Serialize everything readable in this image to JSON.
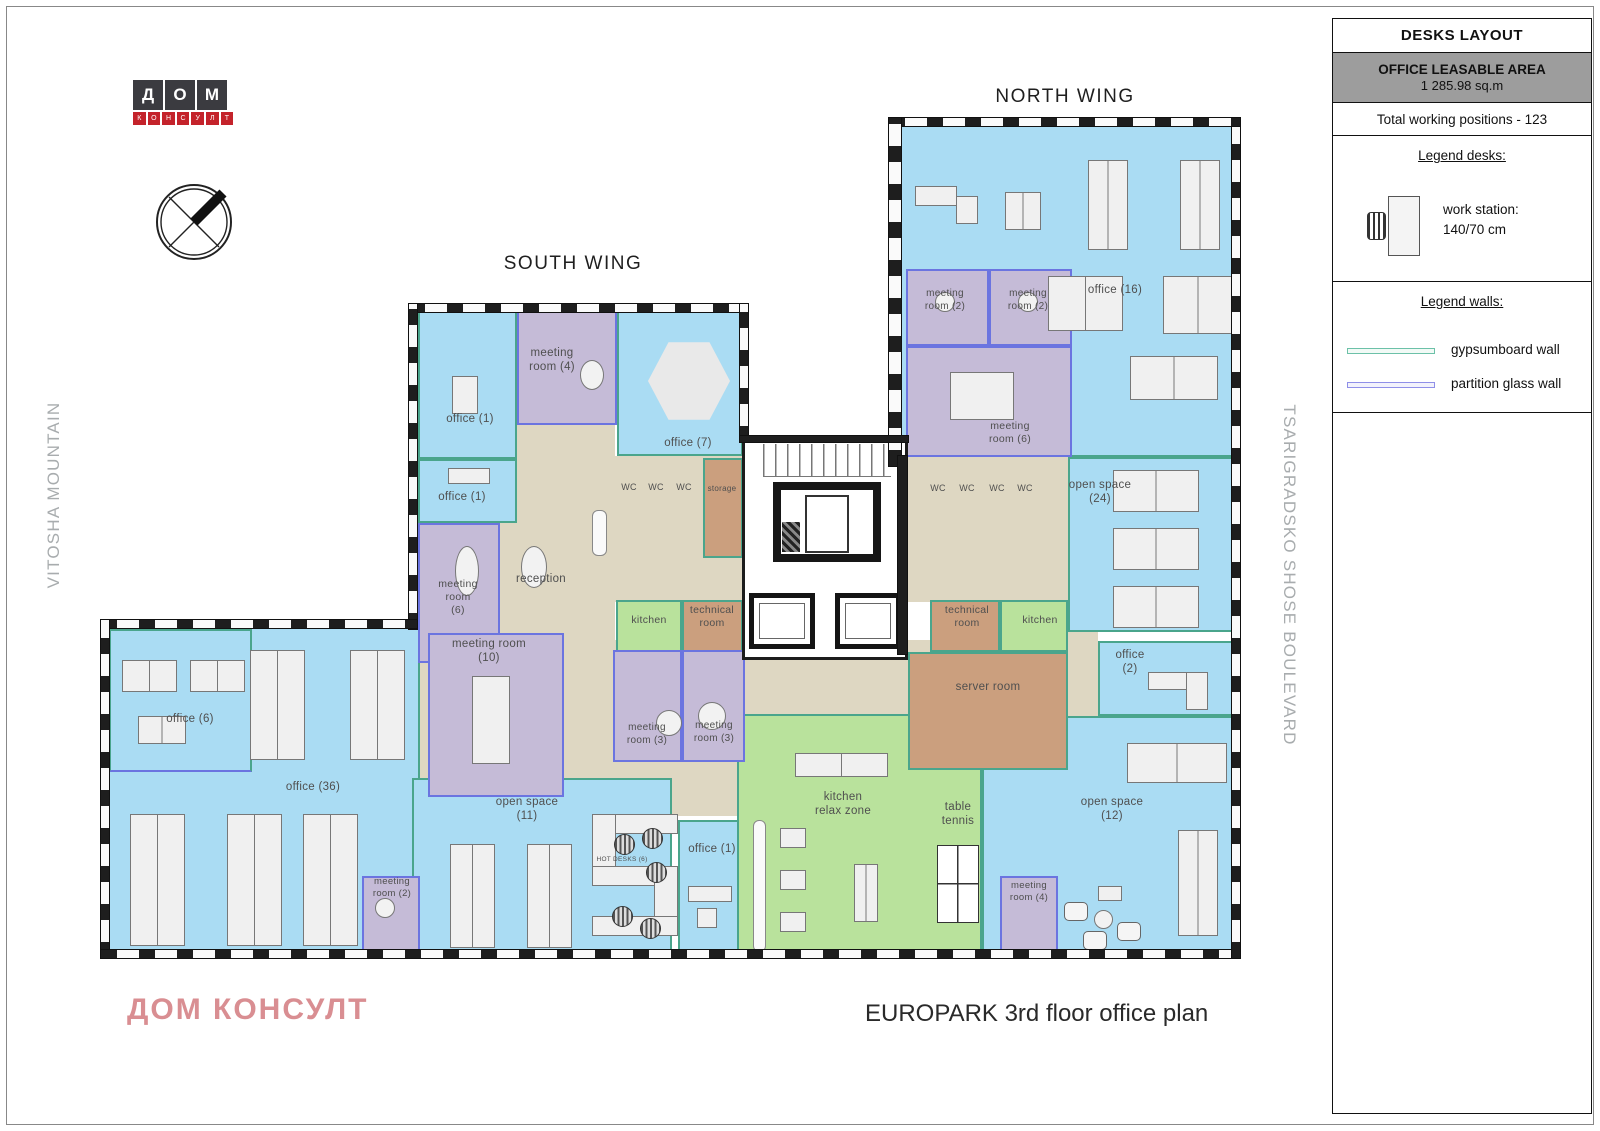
{
  "sidebar": {
    "title": "DESKS LAYOUT",
    "leasable_area_label": "OFFICE LEASABLE AREA",
    "leasable_area_value": "1 285.98 sq.m",
    "total_positions": "Total working positions - 123",
    "legend_desks": {
      "heading": "Legend desks:",
      "workstation_label": "work station:",
      "workstation_size": "140/70 cm"
    },
    "legend_walls": {
      "heading": "Legend walls:",
      "items": [
        {
          "label": "gypsumboard wall",
          "color": "#6cc1a8"
        },
        {
          "label": "partition glass wall",
          "color": "#8f8fe8"
        }
      ]
    }
  },
  "logo": {
    "row1": [
      "Д",
      "О",
      "М"
    ],
    "row2": [
      "К",
      "О",
      "Н",
      "С",
      "У",
      "Л",
      "Т"
    ]
  },
  "headings": {
    "south_wing": "SOUTH WING",
    "north_wing": "NORTH WING"
  },
  "context_labels": {
    "left": "VITOSHA MOUNTAIN",
    "right": "TSARIGRADSKO SHOSE BOULEVARD"
  },
  "footer": {
    "company": "ДОМ КОНСУЛТ",
    "plan_title": "EUROPARK 3rd floor office plan"
  },
  "palette": {
    "office_blue": "#aadcf3",
    "meeting_purple": "#c5bbd7",
    "relax_green": "#b9e29c",
    "service_tan": "#cb9f7e",
    "corridor_beige": "#ded7c2",
    "wall_dark": "#1e1e1e",
    "gypsum_wall": "#4aa58c",
    "glass_wall": "#6b74e0",
    "brand_red": "#c4232b",
    "footer_pink": "#d98e92",
    "context_gray": "#a8acae"
  },
  "plan": {
    "rooms": [
      {
        "n": "corridor-reception",
        "c": "beige",
        "x": 497,
        "y": 423,
        "w": 118,
        "h": 240
      },
      {
        "n": "corridor-center",
        "c": "beige",
        "x": 563,
        "y": 640,
        "w": 419,
        "h": 76
      },
      {
        "n": "corridor-meeting10",
        "c": "beige",
        "x": 414,
        "y": 628,
        "w": 200,
        "h": 172
      },
      {
        "n": "corridor-north",
        "c": "beige",
        "x": 1068,
        "y": 632,
        "w": 30,
        "h": 84
      },
      {
        "n": "corridor-south-mid",
        "c": "beige",
        "x": 598,
        "y": 716,
        "w": 142,
        "h": 100
      },
      {
        "n": "wc-block-south",
        "c": "beige",
        "x": 608,
        "y": 456,
        "w": 135,
        "h": 146
      },
      {
        "n": "wc-block-north",
        "c": "beige",
        "x": 908,
        "y": 456,
        "w": 160,
        "h": 146
      },
      {
        "n": "office-16",
        "c": "blue",
        "x": 893,
        "y": 123,
        "w": 342,
        "h": 334
      },
      {
        "n": "open-space-24",
        "c": "blue",
        "x": 1068,
        "y": 457,
        "w": 167,
        "h": 175
      },
      {
        "n": "office-2",
        "c": "blue",
        "x": 1098,
        "y": 641,
        "w": 137,
        "h": 75
      },
      {
        "n": "open-space-12",
        "c": "blue",
        "x": 982,
        "y": 716,
        "w": 253,
        "h": 240
      },
      {
        "n": "office-1-north",
        "c": "blue",
        "x": 418,
        "y": 311,
        "w": 99,
        "h": 148
      },
      {
        "n": "office-1-mid",
        "c": "blue",
        "x": 418,
        "y": 459,
        "w": 99,
        "h": 64
      },
      {
        "n": "office-7",
        "c": "blue",
        "x": 617,
        "y": 311,
        "w": 126,
        "h": 145
      },
      {
        "n": "office-36",
        "c": "blue",
        "x": 107,
        "y": 627,
        "w": 313,
        "h": 329
      },
      {
        "n": "office-6",
        "c": "blue xc-glass-b",
        "x": 109,
        "y": 629,
        "w": 143,
        "h": 143
      },
      {
        "n": "open-space-11",
        "c": "blue",
        "x": 412,
        "y": 778,
        "w": 260,
        "h": 178
      },
      {
        "n": "office-1-south",
        "c": "blue",
        "x": 678,
        "y": 820,
        "w": 62,
        "h": 136
      },
      {
        "n": "kitchen-south",
        "c": "green",
        "x": 616,
        "y": 600,
        "w": 66,
        "h": 52
      },
      {
        "n": "kitchen-north",
        "c": "green",
        "x": 1000,
        "y": 600,
        "w": 68,
        "h": 52
      },
      {
        "n": "kitchen-relax-zone",
        "c": "green",
        "x": 737,
        "y": 714,
        "w": 245,
        "h": 242
      },
      {
        "n": "storage",
        "c": "tan",
        "x": 703,
        "y": 458,
        "w": 40,
        "h": 100
      },
      {
        "n": "technical-room-south",
        "c": "tan",
        "x": 682,
        "y": 600,
        "w": 61,
        "h": 52
      },
      {
        "n": "technical-room-north",
        "c": "tan",
        "x": 930,
        "y": 600,
        "w": 70,
        "h": 52
      },
      {
        "n": "server-room",
        "c": "tan",
        "x": 908,
        "y": 652,
        "w": 160,
        "h": 118
      },
      {
        "n": "meeting-room-4-south",
        "c": "purple",
        "x": 517,
        "y": 311,
        "w": 100,
        "h": 114
      },
      {
        "n": "meeting-room-6-south",
        "c": "purple",
        "x": 418,
        "y": 523,
        "w": 82,
        "h": 140
      },
      {
        "n": "meeting-room-10",
        "c": "purple",
        "x": 428,
        "y": 633,
        "w": 136,
        "h": 164
      },
      {
        "n": "meeting-room-3-a",
        "c": "purple",
        "x": 613,
        "y": 650,
        "w": 69,
        "h": 112
      },
      {
        "n": "meeting-room-3-b",
        "c": "purple",
        "x": 682,
        "y": 650,
        "w": 63,
        "h": 112
      },
      {
        "n": "meeting-room-2-west",
        "c": "purple",
        "x": 362,
        "y": 876,
        "w": 58,
        "h": 80
      },
      {
        "n": "meeting-room-2-north-a",
        "c": "purple",
        "x": 906,
        "y": 269,
        "w": 83,
        "h": 77
      },
      {
        "n": "meeting-room-2-north-b",
        "c": "purple",
        "x": 989,
        "y": 269,
        "w": 83,
        "h": 77
      },
      {
        "n": "meeting-room-6-north",
        "c": "purple",
        "x": 906,
        "y": 346,
        "w": 166,
        "h": 111
      },
      {
        "n": "meeting-room-4-east",
        "c": "purple",
        "x": 1000,
        "y": 876,
        "w": 58,
        "h": 80
      }
    ],
    "walls": [
      {
        "n": "south-wing-facade-top",
        "dir": "h",
        "x": 408,
        "y": 303,
        "w": 340,
        "h": 10
      },
      {
        "n": "south-wing-facade-west",
        "dir": "v",
        "x": 408,
        "y": 303,
        "w": 10,
        "h": 327
      },
      {
        "n": "west-wing-facade-top",
        "dir": "h",
        "x": 100,
        "y": 619,
        "w": 318,
        "h": 10
      },
      {
        "n": "west-wing-facade-west",
        "dir": "v",
        "x": 100,
        "y": 619,
        "w": 10,
        "h": 340
      },
      {
        "n": "facade-south",
        "dir": "h",
        "x": 100,
        "y": 949,
        "w": 1141,
        "h": 10
      },
      {
        "n": "facade-east",
        "dir": "v",
        "x": 1231,
        "y": 117,
        "w": 10,
        "h": 842
      },
      {
        "n": "north-wing-facade-top",
        "dir": "h",
        "x": 888,
        "y": 117,
        "w": 353,
        "h": 10
      },
      {
        "n": "north-wing-facade-west",
        "dir": "v",
        "x": 888,
        "y": 117,
        "w": 14,
        "h": 350
      },
      {
        "n": "south-wing-facade-east",
        "dir": "v",
        "x": 739,
        "y": 303,
        "w": 10,
        "h": 140
      },
      {
        "n": "core-facade",
        "dir": "h",
        "solid": 1,
        "x": 739,
        "y": 435,
        "w": 170,
        "h": 8
      },
      {
        "n": "core-east-wall",
        "dir": "v",
        "solid": 1,
        "x": 897,
        "y": 455,
        "w": 11,
        "h": 200
      }
    ],
    "labels": [
      {
        "t": "meeting\nroom (4)",
        "x": 552,
        "y": 346
      },
      {
        "t": "office (1)",
        "x": 470,
        "y": 412
      },
      {
        "t": "office (1)",
        "x": 462,
        "y": 490
      },
      {
        "t": "office (7)",
        "x": 688,
        "y": 436
      },
      {
        "t": "reception",
        "x": 541,
        "y": 572
      },
      {
        "t": "meeting\nroom\n(6)",
        "x": 458,
        "y": 578,
        "fs": 10.5
      },
      {
        "t": "meeting room\n(10)",
        "x": 489,
        "y": 637
      },
      {
        "t": "WC",
        "x": 629,
        "y": 482,
        "fs": 9
      },
      {
        "t": "WC",
        "x": 656,
        "y": 482,
        "fs": 9
      },
      {
        "t": "WC",
        "x": 684,
        "y": 482,
        "fs": 9
      },
      {
        "t": "storage",
        "x": 722,
        "y": 484,
        "fs": 8
      },
      {
        "t": "kitchen",
        "x": 649,
        "y": 614,
        "fs": 10.5
      },
      {
        "t": "technical\nroom",
        "x": 712,
        "y": 604,
        "fs": 10.5
      },
      {
        "t": "meeting\nroom (3)",
        "x": 647,
        "y": 722,
        "fs": 10
      },
      {
        "t": "meeting\nroom (3)",
        "x": 714,
        "y": 720,
        "fs": 10
      },
      {
        "t": "open space\n(11)",
        "x": 527,
        "y": 795
      },
      {
        "t": "HOT DESKS (6)",
        "x": 622,
        "y": 856,
        "fs": 6.5
      },
      {
        "t": "office (1)",
        "x": 712,
        "y": 842
      },
      {
        "t": "kitchen\nrelax zone",
        "x": 843,
        "y": 790
      },
      {
        "t": "table\ntennis",
        "x": 958,
        "y": 800
      },
      {
        "t": "office (6)",
        "x": 190,
        "y": 712
      },
      {
        "t": "office (36)",
        "x": 313,
        "y": 780
      },
      {
        "t": "meeting\nroom (2)",
        "x": 392,
        "y": 876,
        "fs": 9.5
      },
      {
        "t": "meeting\nroom (2)",
        "x": 945,
        "y": 288,
        "fs": 10
      },
      {
        "t": "meeting\nroom (2)",
        "x": 1028,
        "y": 288,
        "fs": 10
      },
      {
        "t": "office (16)",
        "x": 1115,
        "y": 283
      },
      {
        "t": "meeting\nroom (6)",
        "x": 1010,
        "y": 420,
        "fs": 10.5
      },
      {
        "t": "WC",
        "x": 938,
        "y": 483,
        "fs": 9
      },
      {
        "t": "WC",
        "x": 967,
        "y": 483,
        "fs": 9
      },
      {
        "t": "WC",
        "x": 997,
        "y": 483,
        "fs": 9
      },
      {
        "t": "WC",
        "x": 1025,
        "y": 483,
        "fs": 9
      },
      {
        "t": "technical\nroom",
        "x": 967,
        "y": 604,
        "fs": 10.5
      },
      {
        "t": "kitchen",
        "x": 1040,
        "y": 614,
        "fs": 10.5
      },
      {
        "t": "open space\n(24)",
        "x": 1100,
        "y": 478
      },
      {
        "t": "office\n(2)",
        "x": 1130,
        "y": 648
      },
      {
        "t": "server room",
        "x": 988,
        "y": 680
      },
      {
        "t": "open space\n(12)",
        "x": 1112,
        "y": 795
      },
      {
        "t": "meeting\nroom (4)",
        "x": 1029,
        "y": 880,
        "fs": 9.5
      }
    ],
    "furniture": [
      {
        "t": "desk",
        "x": 915,
        "y": 186,
        "w": 42,
        "h": 20
      },
      {
        "t": "desk",
        "x": 956,
        "y": 196,
        "w": 22,
        "h": 28
      },
      {
        "t": "desk",
        "x": 1005,
        "y": 192,
        "w": 36,
        "h": 38,
        "s": 1
      },
      {
        "t": "desk",
        "x": 1088,
        "y": 160,
        "w": 40,
        "h": 90,
        "s": 1
      },
      {
        "t": "desk",
        "x": 1180,
        "y": 160,
        "w": 40,
        "h": 90,
        "s": 1
      },
      {
        "t": "desk",
        "x": 1048,
        "y": 276,
        "w": 75,
        "h": 55,
        "s": 1
      },
      {
        "t": "desk",
        "x": 1163,
        "y": 276,
        "w": 70,
        "h": 58,
        "s": 1
      },
      {
        "t": "desk",
        "x": 1130,
        "y": 356,
        "w": 88,
        "h": 44,
        "s": 1
      },
      {
        "t": "desk",
        "x": 1113,
        "y": 470,
        "w": 86,
        "h": 42,
        "s": 1
      },
      {
        "t": "desk",
        "x": 1113,
        "y": 528,
        "w": 86,
        "h": 42,
        "s": 1
      },
      {
        "t": "desk",
        "x": 1113,
        "y": 586,
        "w": 86,
        "h": 42,
        "s": 1
      },
      {
        "t": "desk",
        "x": 1148,
        "y": 672,
        "w": 60,
        "h": 18
      },
      {
        "t": "desk",
        "x": 1186,
        "y": 672,
        "w": 22,
        "h": 38
      },
      {
        "t": "desk",
        "x": 1127,
        "y": 743,
        "w": 100,
        "h": 40,
        "s": 1
      },
      {
        "t": "desk",
        "x": 1178,
        "y": 830,
        "w": 40,
        "h": 106,
        "s": 1
      },
      {
        "t": "desk",
        "x": 1098,
        "y": 886,
        "w": 24,
        "h": 15
      },
      {
        "t": "round",
        "x": 1094,
        "y": 910,
        "w": 19,
        "h": 19
      },
      {
        "t": "sofa",
        "x": 1064,
        "y": 902,
        "w": 24,
        "h": 19
      },
      {
        "t": "sofa",
        "x": 1117,
        "y": 922,
        "w": 24,
        "h": 19
      },
      {
        "t": "sofa",
        "x": 1083,
        "y": 931,
        "w": 24,
        "h": 19
      },
      {
        "t": "round",
        "x": 935,
        "y": 292,
        "w": 20,
        "h": 20
      },
      {
        "t": "round",
        "x": 1018,
        "y": 292,
        "w": 20,
        "h": 20
      },
      {
        "t": "desk",
        "x": 950,
        "y": 372,
        "w": 64,
        "h": 48
      },
      {
        "t": "oval",
        "x": 580,
        "y": 360,
        "w": 24,
        "h": 30
      },
      {
        "t": "hex",
        "x": 648,
        "y": 338,
        "w": 82,
        "h": 86
      },
      {
        "t": "desk",
        "x": 452,
        "y": 376,
        "w": 26,
        "h": 38
      },
      {
        "t": "desk",
        "x": 448,
        "y": 468,
        "w": 42,
        "h": 16
      },
      {
        "t": "oval",
        "x": 455,
        "y": 546,
        "w": 24,
        "h": 50
      },
      {
        "t": "bench",
        "x": 592,
        "y": 510,
        "w": 15,
        "h": 46
      },
      {
        "t": "oval",
        "x": 521,
        "y": 546,
        "w": 26,
        "h": 42
      },
      {
        "t": "desk",
        "x": 472,
        "y": 676,
        "w": 38,
        "h": 88
      },
      {
        "t": "round",
        "x": 656,
        "y": 710,
        "w": 26,
        "h": 26
      },
      {
        "t": "round",
        "x": 698,
        "y": 702,
        "w": 28,
        "h": 28
      },
      {
        "t": "desk",
        "x": 122,
        "y": 660,
        "w": 55,
        "h": 32,
        "s": 1
      },
      {
        "t": "desk",
        "x": 190,
        "y": 660,
        "w": 55,
        "h": 32,
        "s": 1
      },
      {
        "t": "desk",
        "x": 138,
        "y": 716,
        "w": 48,
        "h": 28,
        "s": 1
      },
      {
        "t": "desk",
        "x": 250,
        "y": 650,
        "w": 55,
        "h": 110,
        "s": 1
      },
      {
        "t": "desk",
        "x": 350,
        "y": 650,
        "w": 55,
        "h": 110,
        "s": 1
      },
      {
        "t": "desk",
        "x": 130,
        "y": 814,
        "w": 55,
        "h": 132,
        "s": 1
      },
      {
        "t": "desk",
        "x": 227,
        "y": 814,
        "w": 55,
        "h": 132,
        "s": 1
      },
      {
        "t": "desk",
        "x": 303,
        "y": 814,
        "w": 55,
        "h": 132,
        "s": 1
      },
      {
        "t": "round",
        "x": 375,
        "y": 898,
        "w": 20,
        "h": 20
      },
      {
        "t": "desk",
        "x": 450,
        "y": 844,
        "w": 45,
        "h": 104,
        "s": 1
      },
      {
        "t": "desk",
        "x": 527,
        "y": 844,
        "w": 45,
        "h": 104,
        "s": 1
      },
      {
        "t": "desk",
        "x": 592,
        "y": 814,
        "w": 86,
        "h": 20
      },
      {
        "t": "desk",
        "x": 592,
        "y": 814,
        "w": 24,
        "h": 66
      },
      {
        "t": "desk",
        "x": 592,
        "y": 866,
        "w": 86,
        "h": 20
      },
      {
        "t": "desk",
        "x": 654,
        "y": 866,
        "w": 24,
        "h": 70
      },
      {
        "t": "desk",
        "x": 592,
        "y": 916,
        "w": 86,
        "h": 20
      },
      {
        "t": "schair",
        "x": 614,
        "y": 834,
        "w": 21,
        "h": 21
      },
      {
        "t": "schair",
        "x": 642,
        "y": 828,
        "w": 21,
        "h": 21
      },
      {
        "t": "schair",
        "x": 646,
        "y": 862,
        "w": 21,
        "h": 21
      },
      {
        "t": "schair",
        "x": 612,
        "y": 906,
        "w": 21,
        "h": 21
      },
      {
        "t": "schair",
        "x": 640,
        "y": 918,
        "w": 21,
        "h": 21
      },
      {
        "t": "desk",
        "x": 688,
        "y": 886,
        "w": 44,
        "h": 16
      },
      {
        "t": "desk",
        "x": 697,
        "y": 908,
        "w": 20,
        "h": 20
      },
      {
        "t": "desk",
        "x": 795,
        "y": 753,
        "w": 93,
        "h": 24,
        "s": 1
      },
      {
        "t": "bench",
        "x": 753,
        "y": 820,
        "w": 13,
        "h": 132
      },
      {
        "t": "desk",
        "x": 780,
        "y": 828,
        "w": 26,
        "h": 20
      },
      {
        "t": "desk",
        "x": 780,
        "y": 870,
        "w": 26,
        "h": 20
      },
      {
        "t": "desk",
        "x": 780,
        "y": 912,
        "w": 26,
        "h": 20
      },
      {
        "t": "desk",
        "x": 854,
        "y": 864,
        "w": 24,
        "h": 58,
        "s": 1
      },
      {
        "t": "ttable",
        "x": 937,
        "y": 845,
        "w": 42,
        "h": 78
      }
    ]
  }
}
